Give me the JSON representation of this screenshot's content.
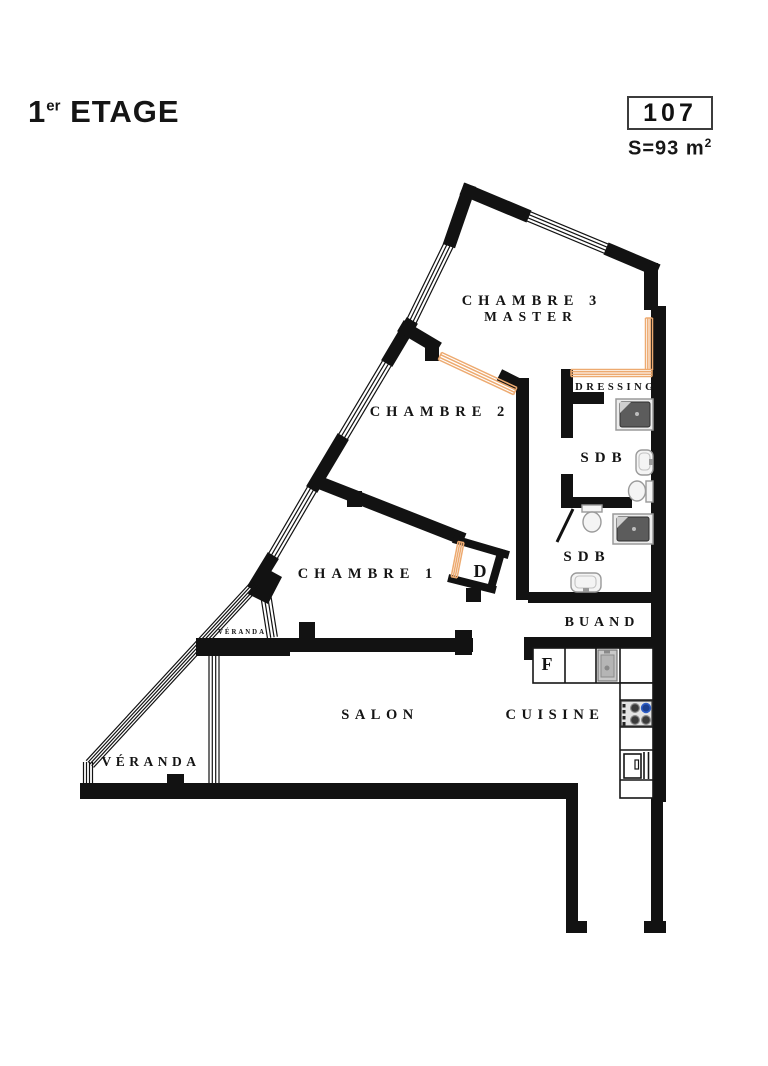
{
  "header": {
    "floor_number": "1",
    "floor_ordinal_suffix": "er",
    "floor_label": "ETAGE",
    "unit_number": "107",
    "area_prefix": "S=93 m",
    "area_exponent": "2"
  },
  "rooms": {
    "chambre3_line1": "CHAMBRE 3",
    "chambre3_line2": "MASTER",
    "chambre2": "CHAMBRE 2",
    "chambre1": "CHAMBRE 1",
    "dressing": "DRESSING",
    "sdb1": "SDB",
    "sdb2": "SDB",
    "buand": "BUAND",
    "salon": "SALON",
    "cuisine": "CUISINE",
    "veranda_small": "VÉRANDA",
    "veranda_large": "VÉRANDA",
    "degagement": "D",
    "fridge": "F"
  },
  "colors": {
    "wall": "#121212",
    "closet": "#edaa70",
    "burner_blue": "#2e5ec7"
  }
}
